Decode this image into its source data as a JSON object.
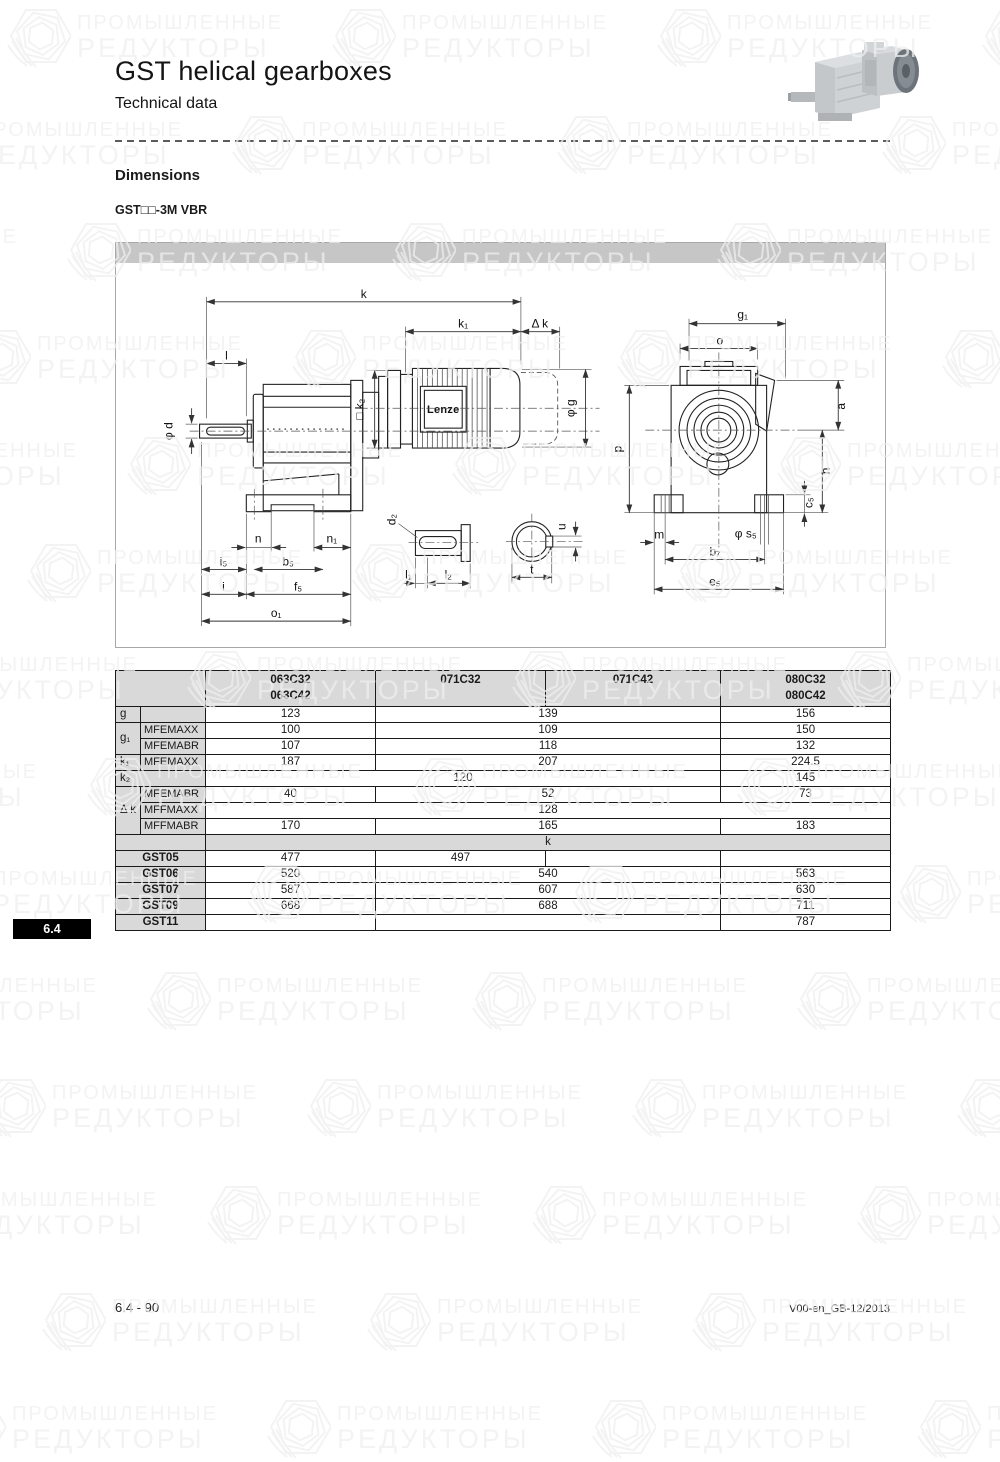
{
  "page": {
    "title": "GST helical gearboxes",
    "subtitle": "Technical data",
    "section_heading": "Dimensions",
    "variant_label": "GST□□-3M VBR",
    "side_tab": "6.4",
    "footer_left": "6.4 - 90",
    "footer_right": "V00-en_GB-12/2013"
  },
  "watermark": {
    "line1": "ПРОМЫШЛЕННЫЕ",
    "line2": "РЕДУКТОРЫ"
  },
  "drawing": {
    "brand_label": "Lenze",
    "labels": {
      "k": "k",
      "k1": "k₁",
      "dk": "Δ k",
      "l": "l",
      "phi_d": "φ d",
      "sq_k2": "□ k₂",
      "phi_g": "φ g",
      "n": "n",
      "n1": "n₁",
      "i5": "i₅",
      "b5": "b₅",
      "i": "i",
      "f5": "f₅",
      "o1": "o₁",
      "d2": "d₂",
      "l1": "l₁",
      "l2": "l₂",
      "u": "u",
      "t": "t",
      "g1": "g₁",
      "o": "o",
      "p": "p",
      "a": "a",
      "h": "h",
      "c5": "c₅",
      "m": "m",
      "phi_s5": "φ s₅",
      "b7": "b₇",
      "e5": "e₅"
    }
  },
  "table": {
    "header": [
      {
        "t": "",
        "c": 2,
        "cls": "lbl"
      },
      {
        "t": "063C32\n063C42"
      },
      {
        "t": "071C32"
      },
      {
        "t": "071C42"
      },
      {
        "t": "080C32\n080C42"
      }
    ],
    "rows": [
      [
        {
          "t": "g",
          "cls": "lbl"
        },
        {
          "t": "",
          "cls": "sub"
        },
        {
          "t": "123"
        },
        {
          "t": "139",
          "c": 2
        },
        {
          "t": "156"
        }
      ],
      [
        {
          "t": "g₁",
          "cls": "lbl",
          "r": 2
        },
        {
          "t": "MFEMAXX",
          "cls": "sub"
        },
        {
          "t": "100"
        },
        {
          "t": "109",
          "c": 2
        },
        {
          "t": "150"
        }
      ],
      [
        {
          "t": "MFEMABR",
          "cls": "sub"
        },
        {
          "t": "107"
        },
        {
          "t": "118",
          "c": 2
        },
        {
          "t": "132"
        }
      ],
      [
        {
          "t": "k₁",
          "cls": "lbl"
        },
        {
          "t": "MFEMAXX",
          "cls": "sub"
        },
        {
          "t": "187"
        },
        {
          "t": "207",
          "c": 2
        },
        {
          "t": "224.5"
        }
      ],
      [
        {
          "t": "k₂",
          "cls": "lbl",
          "c": 2
        },
        {
          "t": "120",
          "c": 3
        },
        {
          "t": "145"
        }
      ],
      [
        {
          "t": "Δ k",
          "cls": "lbl",
          "r": 3
        },
        {
          "t": "MFEMABR",
          "cls": "sub"
        },
        {
          "t": "40"
        },
        {
          "t": "52",
          "c": 2
        },
        {
          "t": "73"
        }
      ],
      [
        {
          "t": "MFFMAXX",
          "cls": "sub"
        },
        {
          "t": "128",
          "c": 4
        }
      ],
      [
        {
          "t": "MFFMABR",
          "cls": "sub"
        },
        {
          "t": "170"
        },
        {
          "t": "165",
          "c": 2
        },
        {
          "t": "183"
        }
      ],
      [
        {
          "t": "",
          "cls": "band",
          "c": 2
        },
        {
          "t": "k",
          "cls": "band",
          "c": 4
        }
      ],
      [
        {
          "t": "GST05",
          "cls": "gst",
          "c": 2
        },
        {
          "t": "477"
        },
        {
          "t": "497"
        },
        {
          "t": ""
        },
        {
          "t": ""
        }
      ],
      [
        {
          "t": "GST06",
          "cls": "gst",
          "c": 2
        },
        {
          "t": "520"
        },
        {
          "t": "540",
          "c": 2
        },
        {
          "t": "563"
        }
      ],
      [
        {
          "t": "GST07",
          "cls": "gst",
          "c": 2
        },
        {
          "t": "587"
        },
        {
          "t": "607",
          "c": 2
        },
        {
          "t": "630"
        }
      ],
      [
        {
          "t": "GST09",
          "cls": "gst",
          "c": 2
        },
        {
          "t": "668"
        },
        {
          "t": "688",
          "c": 2
        },
        {
          "t": "711"
        }
      ],
      [
        {
          "t": "GST11",
          "cls": "gst",
          "c": 2
        },
        {
          "t": ""
        },
        {
          "t": "",
          "c": 2
        },
        {
          "t": "787"
        }
      ]
    ]
  }
}
